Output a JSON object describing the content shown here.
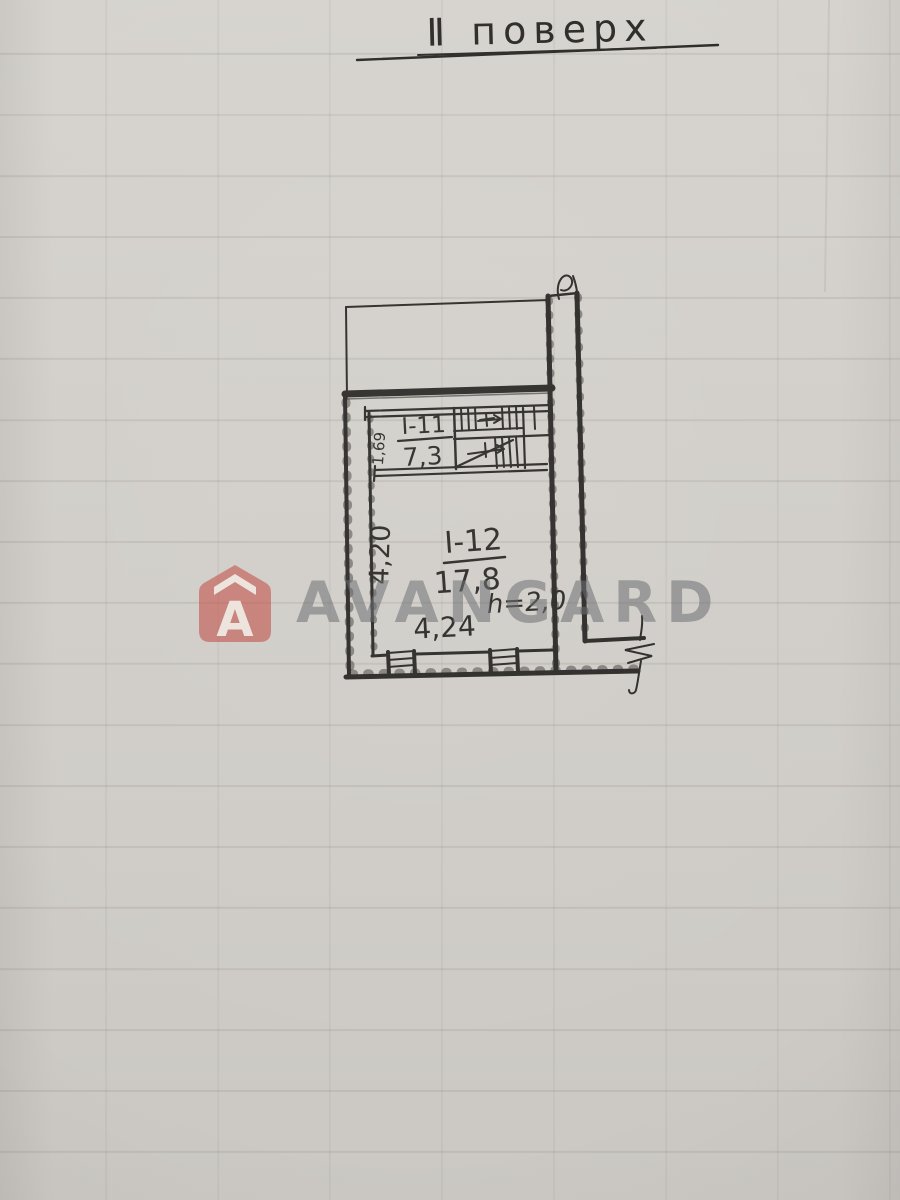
{
  "title": {
    "text": "Ⅱ поверх"
  },
  "plan": {
    "rooms": [
      {
        "id": "I-11",
        "area": "7,3"
      },
      {
        "id": "I-12",
        "area": "17,8"
      }
    ],
    "dimensions": {
      "room1_width": "1,69",
      "room2_depth": "4,20",
      "room2_width": "4,24",
      "ceiling_height": "h=2,0"
    }
  },
  "watermark": {
    "brand": "AVANGARD",
    "logo_letter": "A"
  },
  "colors": {
    "paper": "#d2cfca",
    "ink": "#2d2b28",
    "watermark_red": "#bf4840",
    "watermark_gray": "#6d6f72"
  }
}
